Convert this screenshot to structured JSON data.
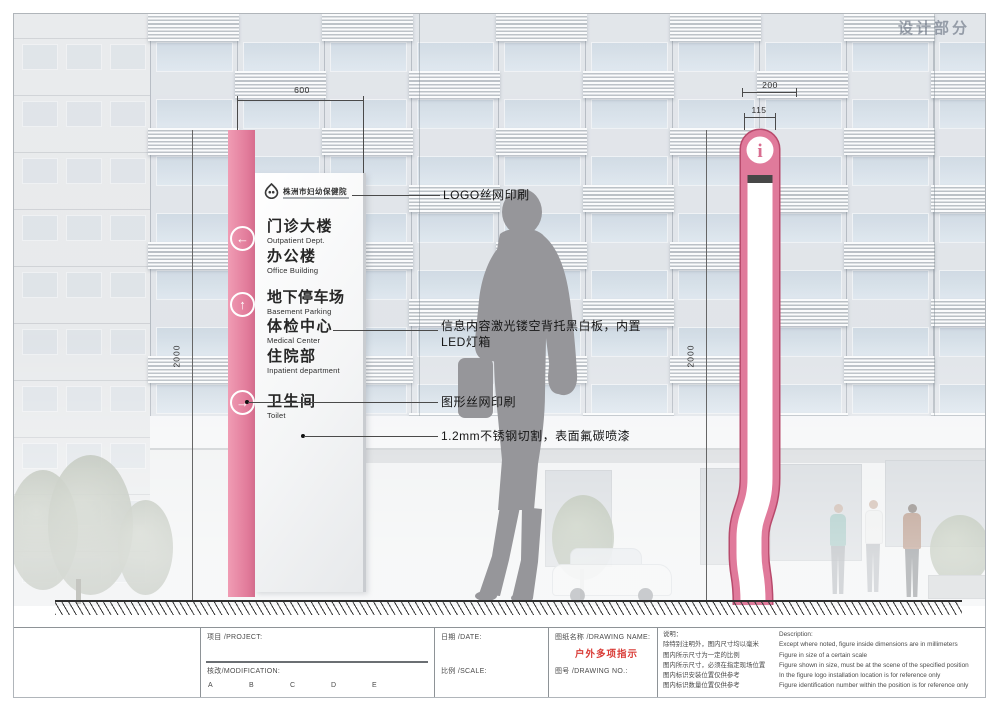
{
  "watermark": "设计部分",
  "colors": {
    "pink": "#e8849f",
    "pink_dark": "#c64a6e",
    "accent_red": "#d93a35",
    "silhouette_gray": "#96969a"
  },
  "front_sign": {
    "hospital_name": "株洲市妇幼保健院",
    "entries": [
      {
        "zh": "门诊大楼",
        "en": "Outpatient Dept."
      },
      {
        "zh": "办公楼",
        "en": "Office Building"
      },
      {
        "zh": "地下停车场",
        "en": "Basement Parking"
      },
      {
        "zh": "体检中心",
        "en": "Medical Center"
      },
      {
        "zh": "住院部",
        "en": "Inpatient department"
      },
      {
        "zh": "卫生间",
        "en": "Toilet"
      }
    ]
  },
  "side_sign": {
    "info_glyph": "i"
  },
  "icons": {
    "arrow_left": "←",
    "arrow_up": "↑",
    "arrow_right": "→"
  },
  "annotations": [
    {
      "lines": [
        "LOGO丝网印刷"
      ]
    },
    {
      "lines": [
        "信息内容激光镂空背托黑白板，内置",
        "LED灯箱"
      ]
    },
    {
      "lines": [
        "图形丝网印刷"
      ]
    },
    {
      "lines": [
        "1.2mm不锈钢切割，表面氟碳喷漆"
      ]
    }
  ],
  "dimensions": {
    "front_width": "600",
    "side_depth": "200",
    "side_width": "115",
    "height_left": "2000",
    "height_right": "2000"
  },
  "title_block": {
    "project_label": "项目 /PROJECT:",
    "modification_label": "核改/MODIFICATION:",
    "revision_marks": [
      "A",
      "B",
      "C",
      "D",
      "E"
    ],
    "date_label": "日期 /DATE:",
    "scale_label": "比例 /SCALE:",
    "drawing_name_label": "图纸名称 /DRAWING NAME:",
    "drawing_name_value": "户外多项指示",
    "drawing_no_label": "图号 /DRAWING NO.:",
    "notes_zh": {
      "title": "说明：",
      "lines": [
        "除特别注明外，图内尺寸均以毫米",
        "图内所示尺寸为一定的比例",
        "图内所示尺寸，必须在指定现场位置",
        "图内标识安装位置仅供参考",
        "图内标识数量位置仅供参考"
      ]
    },
    "notes_en": {
      "title": "Description:",
      "lines": [
        "Except where noted, figure inside dimensions are in millimeters",
        "Figure in size of a certain scale",
        "Figure shown in size, must be at the scene of the specified position",
        "In the figure logo installation location is for reference only",
        "Figure identification number within the position is for reference only"
      ]
    }
  }
}
